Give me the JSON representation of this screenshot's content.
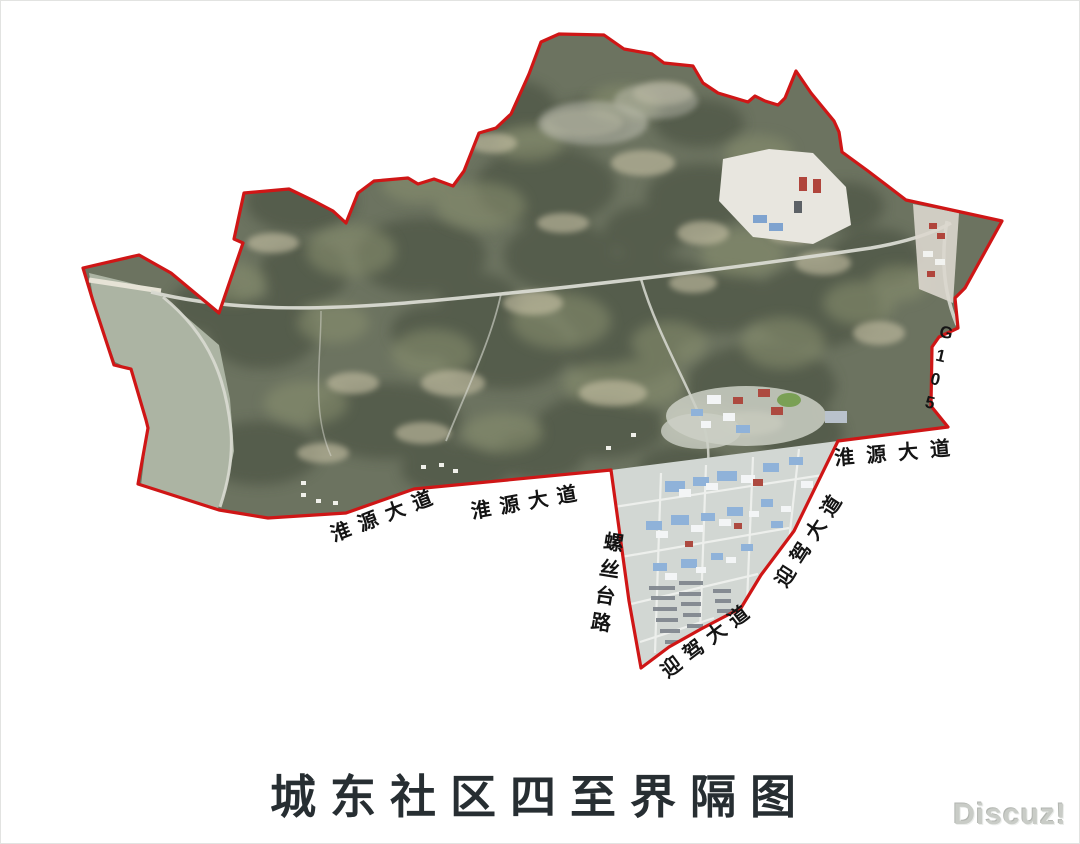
{
  "title": {
    "text": "城东社区四至界隔图",
    "color": "#272e32"
  },
  "watermark": {
    "text": "Discuz!",
    "color": "#c9ccc7"
  },
  "map": {
    "boundary_color": "#cf1616",
    "labels": {
      "huaiyuan_left": "淮源大道",
      "huaiyuan_center": "淮源大道",
      "huaiyuan_right": "淮源大道",
      "luositai": "螺丝台路",
      "yingjia_lower": "迎驾大道",
      "yingjia_right": "迎驾大道",
      "g105": "G105"
    }
  }
}
